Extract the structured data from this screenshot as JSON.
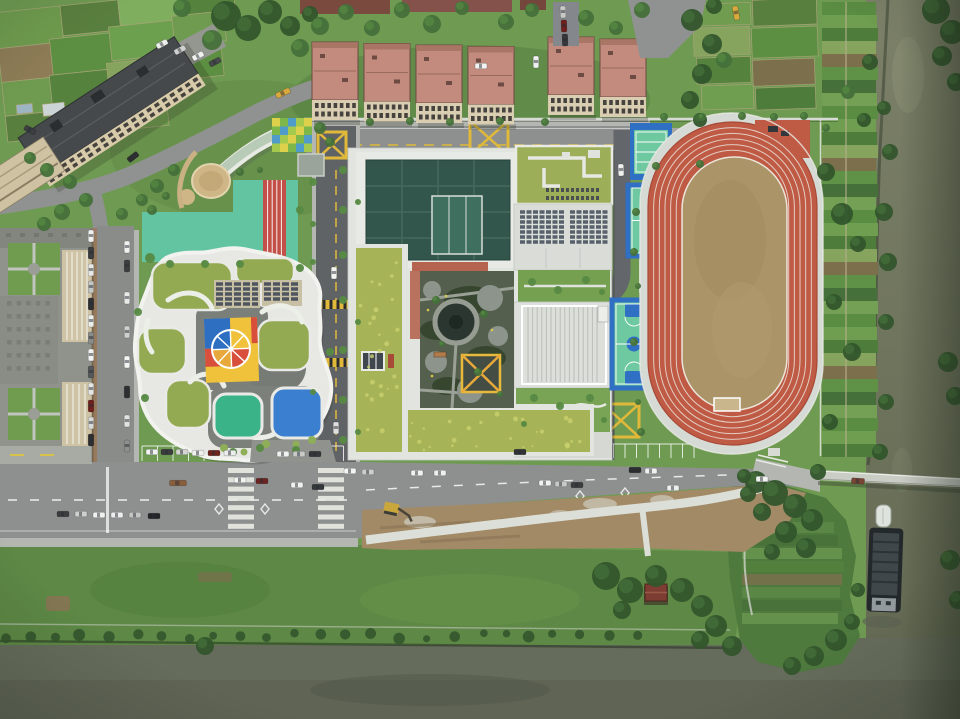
{
  "scene": {
    "type": "aerial-photograph",
    "subject": "top-down drone view of a school campus with kindergarten, green-roof school, running track, basketball courts, apartment blocks, vegetable farms and two rivers",
    "width": 960,
    "height": 719
  },
  "palette": {
    "lawn": "#6f9a52",
    "lawn_dark": "#557e3e",
    "lawn_light": "#7fa95e",
    "bank_grass": "#5d8845",
    "water_right": "#767b66",
    "water_bottom": "#666c5b",
    "water_deep": "#595f50",
    "tree_dark": "#33552c",
    "tree_mid": "#45703a",
    "tree_light": "#578a43",
    "asphalt": "#606366",
    "road_light": "#8d908e",
    "road_pale": "#a6a9a3",
    "sidewalk": "#b4b7b1",
    "brick": "#a1725f",
    "marking_white": "#ecece8",
    "marking_yellow": "#e0b93a",
    "dirt": "#a28a66",
    "dirt_dark": "#8a7455",
    "gravel": "#c9c3b4",
    "path_white": "#dcdfd8",
    "concrete": "#e2e4df",
    "concrete_dim": "#d6dad4",
    "rib_line": "#b9beb8",
    "track_red": "#bf5a45",
    "track_red_dark": "#a84a38",
    "field_tan": "#ab9468",
    "court_blue": "#2f6fc4",
    "court_green": "#6fc9a0",
    "sand": "#cfb687",
    "grass_roof": "#a6b457",
    "grass_roof_speckle": "#c9cf6e",
    "kg_roof_green": "#93aa52",
    "kg_white": "#e7e8e3",
    "gym_teal": "#33564c",
    "gym_teal_light": "#3e6f5f",
    "solar": "#57606b",
    "apt_roof": "#c28b7d",
    "apt_roof_edge": "#6d4a42",
    "apt_wall": "#d9cdb2",
    "apt_window": "#46423e",
    "tall_roof": "#46494b",
    "tall_wall": "#d8cbaa",
    "gray_roof": "#90928c",
    "gray_roof_dark": "#7e807a",
    "beige_wall": "#cfc3a6",
    "play_mint": "#63c4a2",
    "play_red": "#c25048",
    "color_blue": "#2e6fc2",
    "color_red": "#d8503c",
    "color_yellow": "#f0c23c",
    "color_orange": "#e8a93c",
    "pad_teal": "#3bb389",
    "pad_blue": "#3a7fd0",
    "terracotta": "#b5654f",
    "greenhouse_glass": "#b5c9b3",
    "bridge": "#c9cdc6",
    "barge_hull": "#23282a",
    "barge_deck": "#3f474b",
    "excavator_yellow": "#caa73d"
  },
  "housing": {
    "cluster1_x": [
      312,
      364,
      416,
      468
    ],
    "cluster1_y": 42,
    "cluster2_x": [
      548,
      600
    ],
    "cluster2_y": 37,
    "w": 46,
    "h": 58,
    "facade_h": 20
  },
  "vehicles": {
    "items": [
      [
        162,
        44,
        -28,
        "#eceeea"
      ],
      [
        180,
        50,
        -28,
        "#cfd1cf"
      ],
      [
        198,
        56,
        -28,
        "#f1f2f0"
      ],
      [
        215,
        62,
        -28,
        "#46484a"
      ],
      [
        30,
        130,
        28,
        "#3c3e40"
      ],
      [
        133,
        157,
        -38,
        "#2c2e30"
      ],
      [
        283,
        93,
        -24,
        "#d8a93c",
        15
      ],
      [
        481,
        66,
        0,
        "#f2f3f1"
      ],
      [
        563,
        12,
        88,
        "#c8c9c7"
      ],
      [
        564,
        26,
        88,
        "#70201c"
      ],
      [
        565,
        40,
        88,
        "#35373a"
      ],
      [
        736,
        13,
        80,
        "#d8a93c",
        14
      ],
      [
        536,
        62,
        90,
        "#eef0ee"
      ],
      [
        621,
        170,
        88,
        "#f0f1ef"
      ],
      [
        334,
        273,
        90,
        "#f4f5f3"
      ],
      [
        336,
        428,
        90,
        "#dfe0de"
      ],
      [
        91,
        236,
        90,
        "#f0f1ef"
      ],
      [
        91,
        253,
        90,
        "#3a3c3e"
      ],
      [
        91,
        270,
        90,
        "#e8e9e7"
      ],
      [
        91,
        287,
        90,
        "#c4c6c4"
      ],
      [
        91,
        304,
        90,
        "#2f3133"
      ],
      [
        91,
        321,
        90,
        "#eceee9"
      ],
      [
        91,
        338,
        90,
        "#8a8c8a"
      ],
      [
        91,
        355,
        90,
        "#f2f3f1"
      ],
      [
        91,
        372,
        90,
        "#55585a"
      ],
      [
        91,
        389,
        90,
        "#e6e7e5"
      ],
      [
        91,
        406,
        90,
        "#70201c"
      ],
      [
        91,
        423,
        90,
        "#d8d9d7"
      ],
      [
        91,
        440,
        90,
        "#2c2e30"
      ],
      [
        127,
        247,
        90,
        "#f1f2f0"
      ],
      [
        127,
        266,
        90,
        "#3c3e40"
      ],
      [
        127,
        298,
        90,
        "#e9eae8"
      ],
      [
        127,
        332,
        90,
        "#cfd0ce"
      ],
      [
        127,
        362,
        90,
        "#f4f5f3"
      ],
      [
        127,
        392,
        90,
        "#2e3032"
      ],
      [
        127,
        421,
        90,
        "#e2e3e1"
      ],
      [
        127,
        446,
        90,
        "#8e908e"
      ],
      [
        152,
        452,
        0,
        "#f2f3f1"
      ],
      [
        167,
        452,
        0,
        "#3a3c3e"
      ],
      [
        182,
        452,
        0,
        "#d4d5d3"
      ],
      [
        198,
        453,
        0,
        "#f0f1ef"
      ],
      [
        214,
        453,
        0,
        "#70241e"
      ],
      [
        230,
        453,
        0,
        "#eceded"
      ],
      [
        283,
        454,
        0,
        "#f1f2f0"
      ],
      [
        299,
        454,
        0,
        "#c9cac8"
      ],
      [
        315,
        454,
        0,
        "#34363a"
      ],
      [
        63,
        514,
        0,
        "#3a3c3e"
      ],
      [
        81,
        514,
        0,
        "#cfd0ce"
      ],
      [
        99,
        515,
        0,
        "#f0f1ef"
      ],
      [
        117,
        515,
        0,
        "#eceded"
      ],
      [
        135,
        515,
        0,
        "#c4c5c3"
      ],
      [
        154,
        516,
        0,
        "#232527"
      ],
      [
        178,
        483,
        0,
        "#8a5f3c",
        17
      ],
      [
        240,
        480,
        0,
        "#f2f3f1"
      ],
      [
        262,
        481,
        0,
        "#6b2420"
      ],
      [
        297,
        485,
        0,
        "#f0f1ef"
      ],
      [
        318,
        487,
        0,
        "#35383a"
      ],
      [
        350,
        471,
        0,
        "#f3f4f2"
      ],
      [
        368,
        472,
        0,
        "#cdcecc"
      ],
      [
        417,
        473,
        0,
        "#f1f2f0"
      ],
      [
        440,
        473,
        0,
        "#eef0ee"
      ],
      [
        520,
        452,
        0,
        "#303234"
      ],
      [
        545,
        483,
        0,
        "#f2f3f1"
      ],
      [
        561,
        484,
        0,
        "#c8c9c7"
      ],
      [
        577,
        485,
        0,
        "#3a3c3e"
      ],
      [
        635,
        470,
        0,
        "#2b2d2f"
      ],
      [
        651,
        471,
        0,
        "#f0f1ef"
      ],
      [
        673,
        488,
        0,
        "#eceded"
      ],
      [
        762,
        479,
        0,
        "#f2f3f1"
      ],
      [
        858,
        481,
        4,
        "#7a4434",
        13
      ]
    ]
  },
  "trees": {
    "shades": [
      "#33552c",
      "#45703a",
      "#578a43"
    ],
    "items": [
      [
        226,
        16,
        15,
        0
      ],
      [
        248,
        28,
        13,
        0
      ],
      [
        270,
        12,
        12,
        0
      ],
      [
        290,
        26,
        10,
        0
      ],
      [
        212,
        40,
        10,
        1
      ],
      [
        182,
        8,
        9,
        1
      ],
      [
        300,
        48,
        9,
        1
      ],
      [
        310,
        14,
        8,
        0
      ],
      [
        70,
        182,
        7,
        1
      ],
      [
        86,
        200,
        7,
        1
      ],
      [
        62,
        212,
        8,
        1
      ],
      [
        44,
        224,
        7,
        1
      ],
      [
        122,
        214,
        6,
        1
      ],
      [
        142,
        200,
        6,
        1
      ],
      [
        157,
        186,
        7,
        1
      ],
      [
        174,
        170,
        6,
        1
      ],
      [
        30,
        158,
        6,
        1
      ],
      [
        47,
        170,
        7,
        1
      ],
      [
        320,
        26,
        9,
        1
      ],
      [
        346,
        12,
        8,
        1
      ],
      [
        372,
        28,
        8,
        1
      ],
      [
        402,
        10,
        8,
        1
      ],
      [
        432,
        24,
        9,
        1
      ],
      [
        462,
        8,
        7,
        1
      ],
      [
        506,
        22,
        8,
        1
      ],
      [
        532,
        10,
        7,
        1
      ],
      [
        586,
        18,
        8,
        1
      ],
      [
        616,
        28,
        7,
        1
      ],
      [
        642,
        10,
        8,
        1
      ],
      [
        692,
        20,
        11,
        0
      ],
      [
        712,
        44,
        10,
        0
      ],
      [
        702,
        74,
        10,
        0
      ],
      [
        690,
        100,
        9,
        0
      ],
      [
        714,
        6,
        8,
        0
      ],
      [
        724,
        60,
        8,
        1
      ],
      [
        700,
        120,
        7,
        0
      ],
      [
        664,
        117,
        4,
        1
      ],
      [
        702,
        117,
        4,
        1
      ],
      [
        742,
        116,
        4,
        1
      ],
      [
        774,
        117,
        4,
        1
      ],
      [
        804,
        116,
        4,
        1
      ],
      [
        370,
        122,
        4,
        1
      ],
      [
        410,
        121,
        4,
        1
      ],
      [
        450,
        122,
        4,
        1
      ],
      [
        500,
        121,
        4,
        1
      ],
      [
        545,
        122,
        4,
        1
      ],
      [
        343,
        170,
        4,
        2
      ],
      [
        343,
        210,
        4,
        2
      ],
      [
        343,
        255,
        4,
        2
      ],
      [
        343,
        300,
        4,
        2
      ],
      [
        343,
        350,
        4,
        2
      ],
      [
        343,
        400,
        4,
        2
      ],
      [
        343,
        440,
        4,
        2
      ],
      [
        313,
        182,
        4,
        2
      ],
      [
        313,
        224,
        3,
        2
      ],
      [
        358,
        202,
        3,
        2
      ],
      [
        313,
        262,
        3,
        2
      ],
      [
        358,
        322,
        3,
        2
      ],
      [
        313,
        392,
        3,
        2
      ],
      [
        358,
        432,
        3,
        2
      ],
      [
        532,
        282,
        4,
        2
      ],
      [
        558,
        290,
        4,
        2
      ],
      [
        586,
        280,
        4,
        2
      ],
      [
        602,
        292,
        3,
        2
      ],
      [
        534,
        398,
        4,
        2
      ],
      [
        560,
        406,
        4,
        2
      ],
      [
        590,
        398,
        4,
        2
      ],
      [
        524,
        424,
        3,
        2
      ],
      [
        604,
        420,
        3,
        2
      ],
      [
        436,
        300,
        4,
        1
      ],
      [
        484,
        314,
        4,
        1
      ],
      [
        442,
        344,
        3,
        1
      ],
      [
        478,
        372,
        4,
        1
      ],
      [
        500,
        394,
        3,
        1
      ],
      [
        636,
        212,
        4,
        1
      ],
      [
        634,
        252,
        4,
        1
      ],
      [
        638,
        286,
        3,
        1
      ],
      [
        634,
        342,
        4,
        1
      ],
      [
        638,
        402,
        3,
        1
      ],
      [
        641,
        432,
        4,
        1
      ],
      [
        826,
        128,
        4,
        1
      ],
      [
        826,
        172,
        9,
        0
      ],
      [
        842,
        214,
        11,
        0
      ],
      [
        858,
        244,
        8,
        0
      ],
      [
        834,
        302,
        8,
        0
      ],
      [
        852,
        352,
        9,
        0
      ],
      [
        830,
        422,
        8,
        0
      ],
      [
        864,
        120,
        7,
        0
      ],
      [
        870,
        62,
        8,
        0
      ],
      [
        848,
        92,
        7,
        1
      ],
      [
        884,
        212,
        9,
        0
      ],
      [
        888,
        262,
        9,
        0
      ],
      [
        886,
        322,
        8,
        0
      ],
      [
        890,
        152,
        8,
        0
      ],
      [
        886,
        402,
        8,
        0
      ],
      [
        880,
        452,
        8,
        0
      ],
      [
        884,
        108,
        7,
        0
      ],
      [
        936,
        10,
        14,
        0
      ],
      [
        952,
        32,
        12,
        0
      ],
      [
        942,
        56,
        10,
        0
      ],
      [
        956,
        82,
        9,
        0
      ],
      [
        948,
        362,
        10,
        0
      ],
      [
        955,
        396,
        9,
        0
      ],
      [
        950,
        560,
        10,
        0
      ],
      [
        958,
        600,
        9,
        0
      ],
      [
        756,
        482,
        11,
        0
      ],
      [
        775,
        493,
        13,
        0
      ],
      [
        795,
        506,
        12,
        0
      ],
      [
        812,
        520,
        11,
        0
      ],
      [
        762,
        512,
        9,
        0
      ],
      [
        786,
        532,
        11,
        0
      ],
      [
        806,
        548,
        10,
        0
      ],
      [
        772,
        552,
        8,
        0
      ],
      [
        748,
        494,
        8,
        0
      ],
      [
        818,
        472,
        8,
        0
      ],
      [
        836,
        640,
        11,
        0
      ],
      [
        814,
        656,
        10,
        0
      ],
      [
        792,
        666,
        9,
        0
      ],
      [
        852,
        622,
        8,
        0
      ],
      [
        858,
        590,
        7,
        0
      ],
      [
        744,
        476,
        7,
        0
      ],
      [
        606,
        576,
        14,
        0
      ],
      [
        630,
        590,
        13,
        0
      ],
      [
        656,
        576,
        11,
        0
      ],
      [
        682,
        590,
        12,
        0
      ],
      [
        702,
        606,
        11,
        0
      ],
      [
        622,
        610,
        9,
        0
      ],
      [
        716,
        626,
        11,
        0
      ],
      [
        732,
        646,
        10,
        0
      ],
      [
        700,
        640,
        9,
        0
      ],
      [
        205,
        646,
        9,
        0
      ],
      [
        150,
        258,
        5,
        2
      ],
      [
        300,
        268,
        4,
        2
      ],
      [
        138,
        312,
        4,
        2
      ],
      [
        330,
        352,
        4,
        2
      ],
      [
        145,
        398,
        4,
        2
      ],
      [
        296,
        450,
        4,
        2
      ],
      [
        260,
        448,
        4,
        2
      ],
      [
        233,
        452,
        4,
        2
      ],
      [
        152,
        210,
        5,
        1
      ],
      [
        166,
        196,
        4,
        1
      ],
      [
        240,
        172,
        4,
        1
      ],
      [
        260,
        170,
        3,
        1
      ],
      [
        300,
        210,
        4,
        2
      ],
      [
        240,
        264,
        4,
        2
      ],
      [
        205,
        264,
        4,
        2
      ],
      [
        170,
        264,
        4,
        2
      ],
      [
        320,
        128,
        6,
        1
      ],
      [
        330,
        142,
        5,
        1
      ],
      [
        656,
        166,
        4,
        1
      ],
      [
        700,
        164,
        4,
        1
      ]
    ]
  },
  "farms": {
    "top_left": [
      [
        0,
        0,
        66,
        36,
        "#6f9c4e"
      ],
      [
        66,
        0,
        58,
        30,
        "#597f3e"
      ],
      [
        124,
        0,
        66,
        26,
        "#7fae5e"
      ],
      [
        190,
        0,
        50,
        22,
        "#55823c"
      ],
      [
        0,
        36,
        54,
        34,
        "#8d7c56"
      ],
      [
        52,
        32,
        62,
        36,
        "#5d8f42"
      ],
      [
        112,
        26,
        66,
        34,
        "#6ca04f"
      ],
      [
        176,
        22,
        52,
        30,
        "#6f9b50"
      ],
      [
        0,
        70,
        50,
        34,
        "#6f9b50"
      ],
      [
        48,
        68,
        60,
        36,
        "#55823c"
      ],
      [
        106,
        62,
        64,
        40,
        "#86a45e"
      ],
      [
        168,
        52,
        54,
        34,
        "#5d8f42"
      ],
      [
        0,
        104,
        46,
        26,
        "#597f3e"
      ],
      [
        44,
        102,
        58,
        28,
        "#8d7c56"
      ],
      [
        100,
        100,
        62,
        30,
        "#6f9c4e"
      ],
      [
        38,
        96,
        22,
        12,
        "#cdd4d6"
      ],
      [
        12,
        94,
        16,
        9,
        "#9db4c2"
      ]
    ],
    "north_east": [
      [
        692,
        2,
        60,
        22,
        "#6f9c4e"
      ],
      [
        754,
        0,
        64,
        26,
        "#597f3e"
      ],
      [
        694,
        26,
        56,
        28,
        "#86a45e"
      ],
      [
        752,
        28,
        66,
        30,
        "#5d8f42"
      ],
      [
        696,
        56,
        54,
        26,
        "#55823c"
      ],
      [
        752,
        60,
        62,
        26,
        "#7b6f4c"
      ],
      [
        700,
        84,
        52,
        24,
        "#6f9e50"
      ],
      [
        754,
        88,
        60,
        22,
        "#4e7c3a"
      ]
    ],
    "right_strip": {
      "x": 822,
      "y": 2,
      "w": 54,
      "rows": 35,
      "row_h": 13,
      "colors": [
        "#5a8c42",
        "#6f9e50",
        "#4e7c3a",
        "#86a45e",
        "#7b6f4c",
        "#5f9247",
        "#46703a",
        "#74a055"
      ]
    }
  },
  "sports": {
    "track": {
      "x": 648,
      "y": 122,
      "w": 169,
      "h": 323,
      "lanes": 5,
      "gap": 5.66,
      "line_color": "#e9e2d8"
    }
  }
}
